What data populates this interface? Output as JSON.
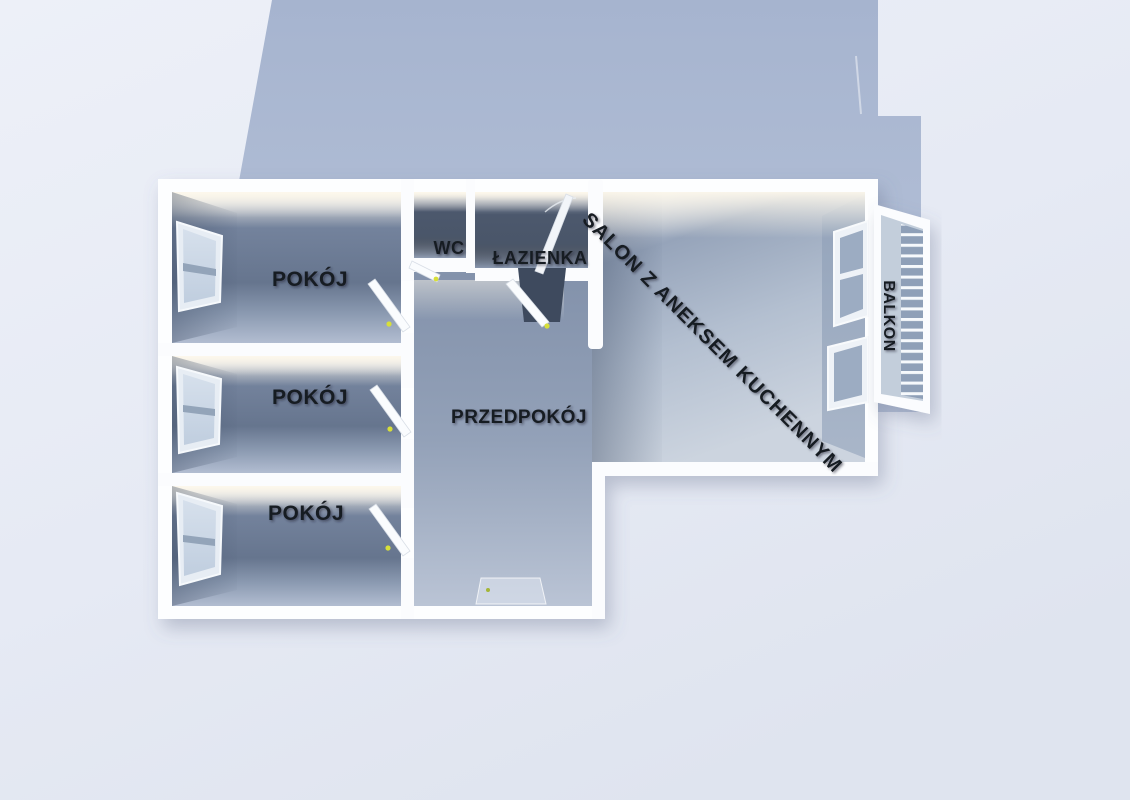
{
  "title": "3D apartment floor plan render",
  "palette": {
    "background": "#e9edf6",
    "building_shadow": "#a9b7d1",
    "walls": "#ffffff",
    "room_wall": "#66758e",
    "room_floor": "#b5c0d3",
    "salon_floor": "#c8d1dd",
    "wet_room_dark": "#49566b",
    "door_handle": "#d7df39",
    "ceiling_glow": "#f6f1e6"
  },
  "rooms": [
    {
      "id": "pokoj-1",
      "label": "POKÓJ"
    },
    {
      "id": "pokoj-2",
      "label": "POKÓJ"
    },
    {
      "id": "pokoj-3",
      "label": "POKÓJ"
    },
    {
      "id": "wc",
      "label": "WC"
    },
    {
      "id": "lazienka",
      "label": "ŁAZIENKA"
    },
    {
      "id": "przedpokoj",
      "label": "PRZEDPOKÓJ"
    },
    {
      "id": "salon",
      "label": "SALON Z ANEKSEM KUCHENNYM"
    },
    {
      "id": "balkon",
      "label": "BALKON"
    }
  ]
}
